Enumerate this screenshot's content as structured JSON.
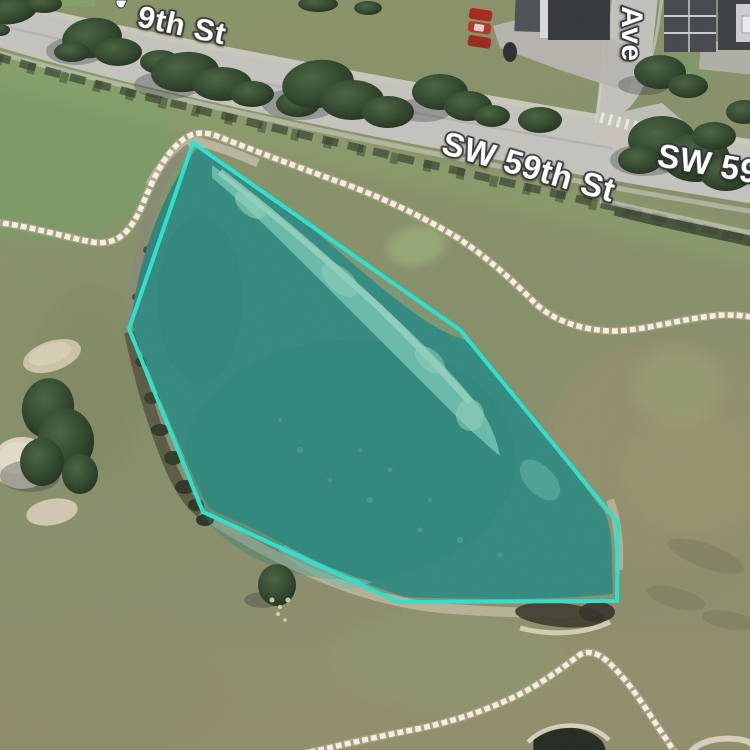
{
  "map": {
    "view_type": "satellite-aerial",
    "street_labels": {
      "top_partial": "9th St",
      "center": "SW 59th St",
      "right_clipped": "SW 59th St",
      "cross_street_vertical": "Ave"
    },
    "selection_polygon": {
      "name": "pond-boundary-selection",
      "points": "193,143 129,329 203,512 398,602 617,601 618,523 460,330",
      "stroke_color": "#2DE1CD",
      "fill_color": "rgba(45,225,205,0.08)"
    },
    "colors": {
      "pond_water": "#35837A",
      "shallow_water": "#74BCAA",
      "road_asphalt": "#C5C3BD",
      "grass_base": "#87916B",
      "cart_path_dash": "#F5F0E1",
      "cart_path_base": "#B3A88C",
      "tree_canopy": "#33492E",
      "sand_bunker": "#D6CDB4",
      "building_roof": "#45494D",
      "red_car": "#B5342A"
    }
  }
}
